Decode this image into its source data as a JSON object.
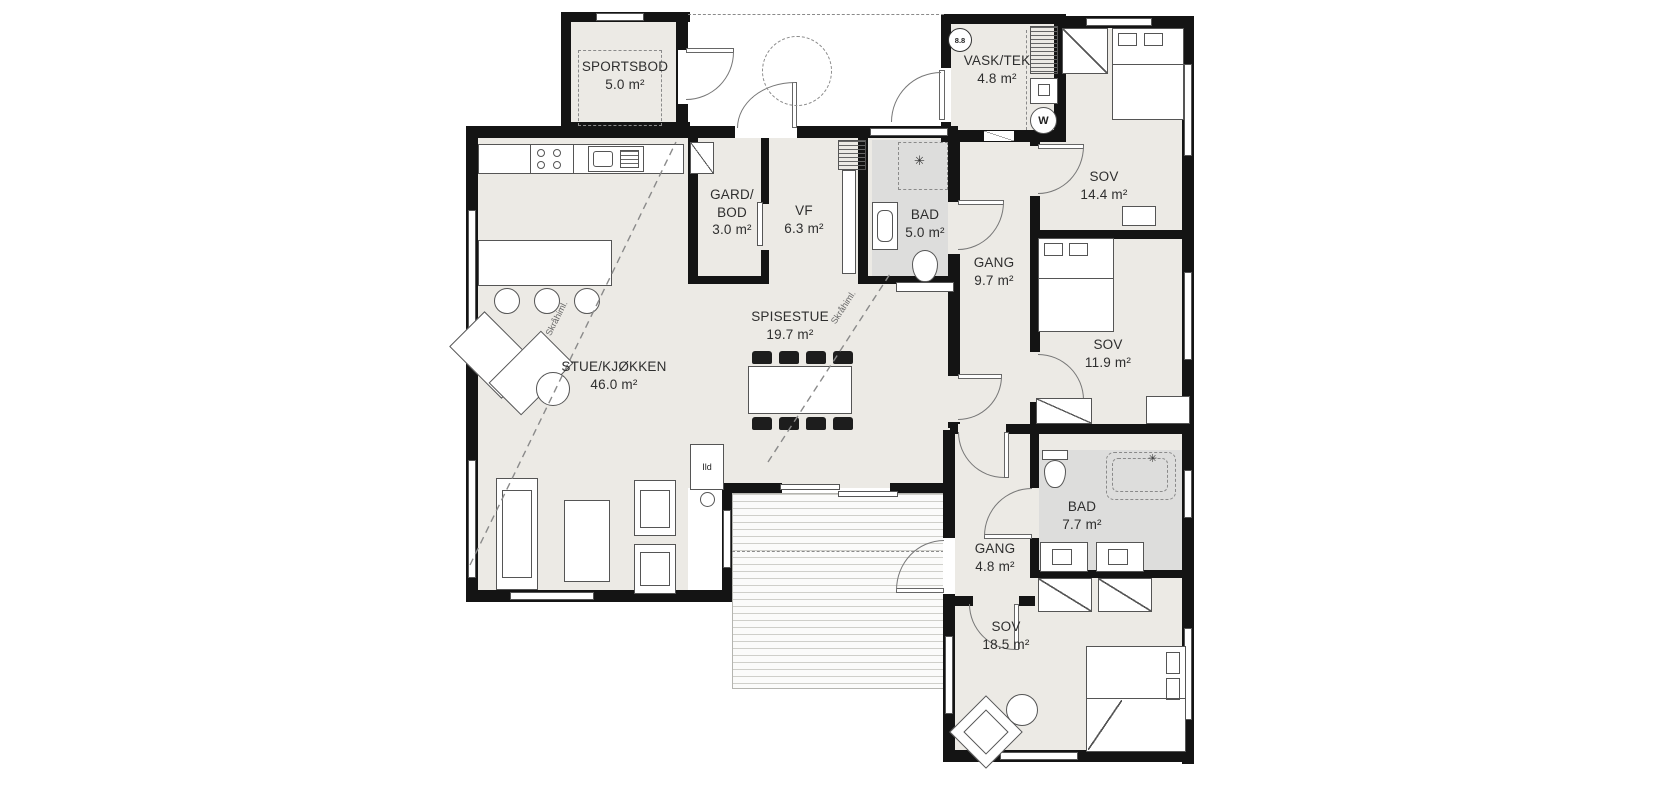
{
  "rooms": [
    {
      "name": "SPORTSBOD",
      "area": "5.0 m²"
    },
    {
      "name": "VASK/TEK",
      "area": "4.8 m²"
    },
    {
      "line1": "GARD/",
      "line2": "BOD",
      "area": "3.0 m²"
    },
    {
      "name": "VF",
      "area": "6.3 m²"
    },
    {
      "name": "BAD",
      "area": "5.0 m²"
    },
    {
      "name": "SOV",
      "area": "14.4 m²"
    },
    {
      "name": "GANG",
      "area": "9.7 m²"
    },
    {
      "name": "SOV",
      "area": "11.9 m²"
    },
    {
      "name": "SPISESTUE",
      "area": "19.7 m²"
    },
    {
      "name": "STUE/KJØKKEN",
      "area": "46.0 m²"
    },
    {
      "name": "BAD",
      "area": "7.7 m²"
    },
    {
      "name": "GANG",
      "area": "4.8 m²"
    },
    {
      "name": "SOV",
      "area": "18.5 m²"
    }
  ],
  "annotations": {
    "fireplace_label": "Ild",
    "washer_label": "W",
    "section_marker": "8.8",
    "ceiling_label": "Skråhiml.",
    "shower_symbol": "✳"
  },
  "colors": {
    "wall": "#141414",
    "floor": "#eceae5",
    "wet_floor": "#dddddc",
    "line": "#555555"
  }
}
